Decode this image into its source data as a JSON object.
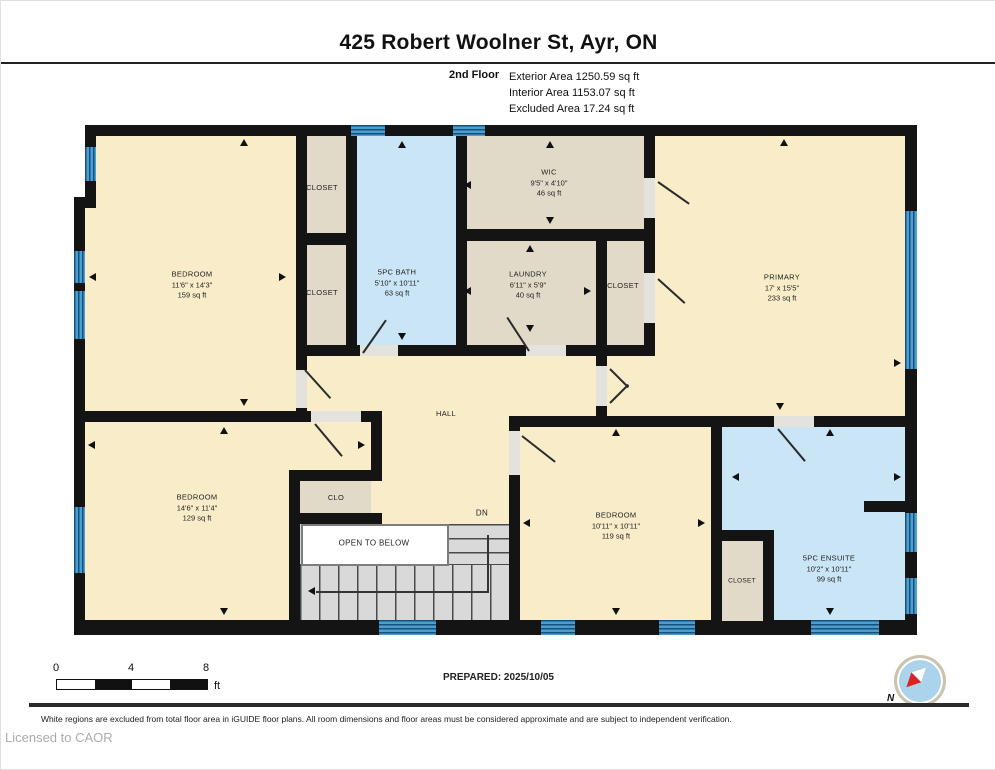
{
  "header": {
    "title": "425 Robert Woolner St, Ayr, ON",
    "floor_label": "2nd Floor",
    "areas": [
      "Exterior Area 1250.59 sq ft",
      "Interior Area 1153.07 sq ft",
      "Excluded Area 17.24 sq ft"
    ]
  },
  "rooms": {
    "bedroom_tl": {
      "name": "BEDROOM",
      "dims": "11'6\" x 14'3\"",
      "area": "159 sq ft"
    },
    "closet_a": {
      "name": "CLOSET"
    },
    "closet_b": {
      "name": "CLOSET"
    },
    "bath": {
      "name": "5PC BATH",
      "dims": "5'10\" x 10'11\"",
      "area": "63 sq ft"
    },
    "wic": {
      "name": "WIC",
      "dims": "9'5\" x 4'10\"",
      "area": "46 sq ft"
    },
    "laundry": {
      "name": "LAUNDRY",
      "dims": "6'11\" x 5'9\"",
      "area": "40 sq ft"
    },
    "closet_c": {
      "name": "CLOSET"
    },
    "primary": {
      "name": "PRIMARY",
      "dims": "17' x 15'5\"",
      "area": "233 sq ft"
    },
    "hall": {
      "name": "HALL"
    },
    "bedroom_bl": {
      "name": "BEDROOM",
      "dims": "14'6\" x 11'4\"",
      "area": "129 sq ft"
    },
    "clo": {
      "name": "CLO"
    },
    "open_to_below": {
      "name": "OPEN TO BELOW"
    },
    "stairs": {
      "dn_label": "DN"
    },
    "bedroom_bm": {
      "name": "BEDROOM",
      "dims": "10'11\" x 10'11\"",
      "area": "119 sq ft"
    },
    "closet_d": {
      "name": "CLOSET"
    },
    "ensuite": {
      "name": "5PC ENSUITE",
      "dims": "10'2\" x 10'11\"",
      "area": "99 sq ft"
    }
  },
  "footer": {
    "scale_ticks": [
      "0",
      "4",
      "8"
    ],
    "scale_unit": "ft",
    "prepared": "PREPARED: 2025/10/05",
    "compass": "N",
    "disclaimer": "White regions are excluded from total floor area in iGUIDE floor plans. All room dimensions and floor areas must be considered approximate and are subject to independent verification.",
    "license": "Licensed to CAOR"
  },
  "colors": {
    "room_cream": "#F8ECC9",
    "closet_tan": "#E2DAC8",
    "bath_blue": "#C9E5F6",
    "window_blue": "#4D9ECF",
    "wall_black": "#141414",
    "stairs_gray": "#D9D9D9"
  }
}
